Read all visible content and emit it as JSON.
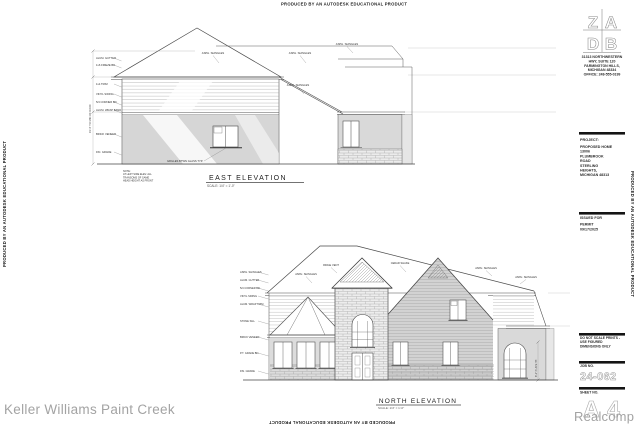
{
  "page": {
    "watermark_autodesk": "PRODUCED BY AN AUTODESK EDUCATIONAL PRODUCT",
    "watermark_keller": "Keller Williams Paint Creek",
    "watermark_realcomp": "Realcomp",
    "colors": {
      "paper": "#ffffff",
      "line": "#4a4a4a",
      "shade": "#d6d6d6",
      "gray_text": "#a3a3a3"
    }
  },
  "title_block": {
    "logo_letters": [
      "Z",
      "A",
      "D",
      "B"
    ],
    "firm_address_lines": [
      "31313 NORTHWESTERN",
      "HWY, SUITE 120",
      "FARMINGTON HILLS,",
      "MICHIGAN 48334",
      "OFFICE: 248-555-0199"
    ],
    "project_label": "PROJECT:",
    "project_lines": [
      "PROPOSED HOME",
      "13006",
      "PLUMBROOK",
      "ROAD",
      "STERLING",
      "HEIGHTS,",
      "MICHIGAN 48313"
    ],
    "issued_label": "ISSUED FOR",
    "issued_lines": [
      "PERMIT",
      "09/17/2025"
    ],
    "disclaimer_lines": [
      "DO NOT SCALE PRINTS -",
      "USE FIGURED",
      "DIMENSIONS ONLY"
    ],
    "job_label": "JOB NO.",
    "job_number": "24-062",
    "sheet_label": "SHEET NO.",
    "sheet_number": "A 4"
  },
  "east": {
    "title": "EAST ELEVATION",
    "scale": "SCALE: 1/4\" = 1'-0\"",
    "left_notes": [
      "ALUM. GUTTER",
      "1x6 FRIEZE BD.",
      "1x4 TRIM",
      "VINYL SIDING",
      "5/4 CORNER BD.",
      "ALUM. WRAP BAND",
      "BRICK VENEER",
      "FIN. GRADE"
    ],
    "roof_notes": [
      "ASPH. SHINGLES",
      "ASPH. SHINGLES",
      "ASPH. SHINGLES",
      "ASPH. SHINGLES"
    ],
    "window_note": "GRILLES BTWN GLASS TYP.",
    "dim_note": "19'-4\" TO MID OF ROOF",
    "bottom_notes": [
      "NOTE:",
      "AT LEFT SIDE ELEV. ALL",
      "TRANSOMS OF SAME",
      "HEAD HEIGHT AS FRONT"
    ]
  },
  "north": {
    "title": "NORTH ELEVATION",
    "scale": "SCALE: 1/4\" = 1'-0\"",
    "left_notes": [
      "ASPH. SHINGLES",
      "ALUM. GUTTER",
      "5/4 CORNER BD.",
      "VINYL SIDING",
      "ALUM. WRAP TRIM",
      "STONE SILL",
      "BRICK VENEER",
      "P.T. GRADE BD.",
      "FIN. GRADE"
    ],
    "roof_notes": [
      "ASPH. SHINGLES",
      "RIDGE VENT",
      "CEDAR SHAKE",
      "ASPH. SHINGLES",
      "ASPH. SHINGLES"
    ],
    "right_dim_note": "8'-1\" PLATE HT."
  }
}
